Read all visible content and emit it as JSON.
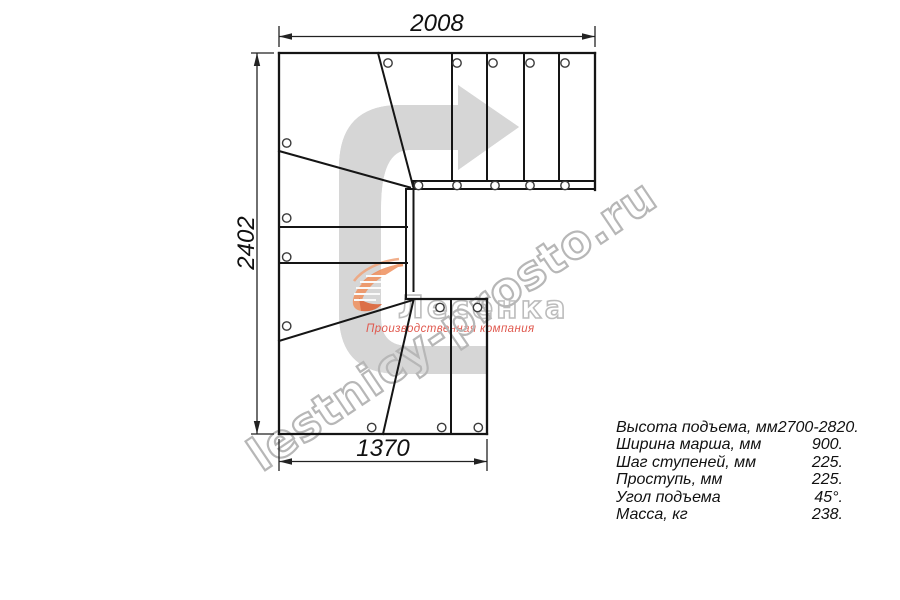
{
  "watermark": {
    "site": "lestnicy-prosto.ru"
  },
  "logo": {
    "company": "Лесенка",
    "tagline": "Производственная компания"
  },
  "dimensions": {
    "top": "2008",
    "left": "2402",
    "bottom": "1370"
  },
  "specs": {
    "rows": [
      {
        "label": "Высота подъема, мм",
        "value": "2700-2820."
      },
      {
        "label": "Ширина марша, мм",
        "value": "900."
      },
      {
        "label": "Шаг ступеней, мм",
        "value": "225."
      },
      {
        "label": "Проступь, мм",
        "value": "225."
      },
      {
        "label": "Угол подъема",
        "value": "45°."
      },
      {
        "label": "Масса, кг",
        "value": "238."
      }
    ]
  },
  "colors": {
    "line": "#151515",
    "dimension": "#222222",
    "arrow_gray": "#d6d6d6",
    "logo_orange": "#f09463",
    "logo_orange_dark": "#dd6134",
    "logo_red": "#e0584e",
    "watermark_gray": "#b7b7b7"
  }
}
